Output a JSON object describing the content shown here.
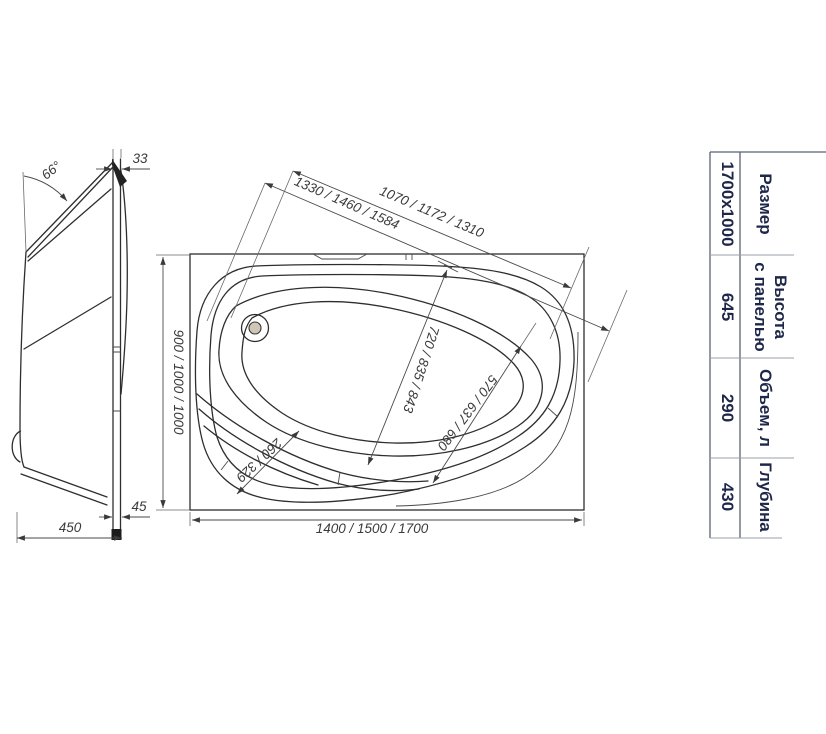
{
  "side_view": {
    "angle_label": "66°",
    "rim_thickness": "33",
    "base_depth": "450",
    "panel_offset": "45"
  },
  "top_view": {
    "length_bottom": "1400 / 1500 / 1700",
    "width_left": "900 / 1000 / 1000",
    "diagonal_full": "1330 / 1460 / 1584",
    "diagonal_inner": "1070 / 1172 / 1310",
    "bowl_length": "720 / 835 / 843",
    "bowl_width": "570 / 637 / 680",
    "corner_step": "260 / 329"
  },
  "spec_table": {
    "size": {
      "label": "Размер",
      "value": "1700x1000"
    },
    "height": {
      "label_line1": "Высота",
      "label_line2": "с панелью",
      "value": "645"
    },
    "volume": {
      "label": "Объем, л",
      "value": "290"
    },
    "depth": {
      "label": "Глубина",
      "value": "430"
    }
  },
  "colors": {
    "line": "#2e2e2e",
    "table_text": "#1e2749",
    "background": "#ffffff"
  }
}
